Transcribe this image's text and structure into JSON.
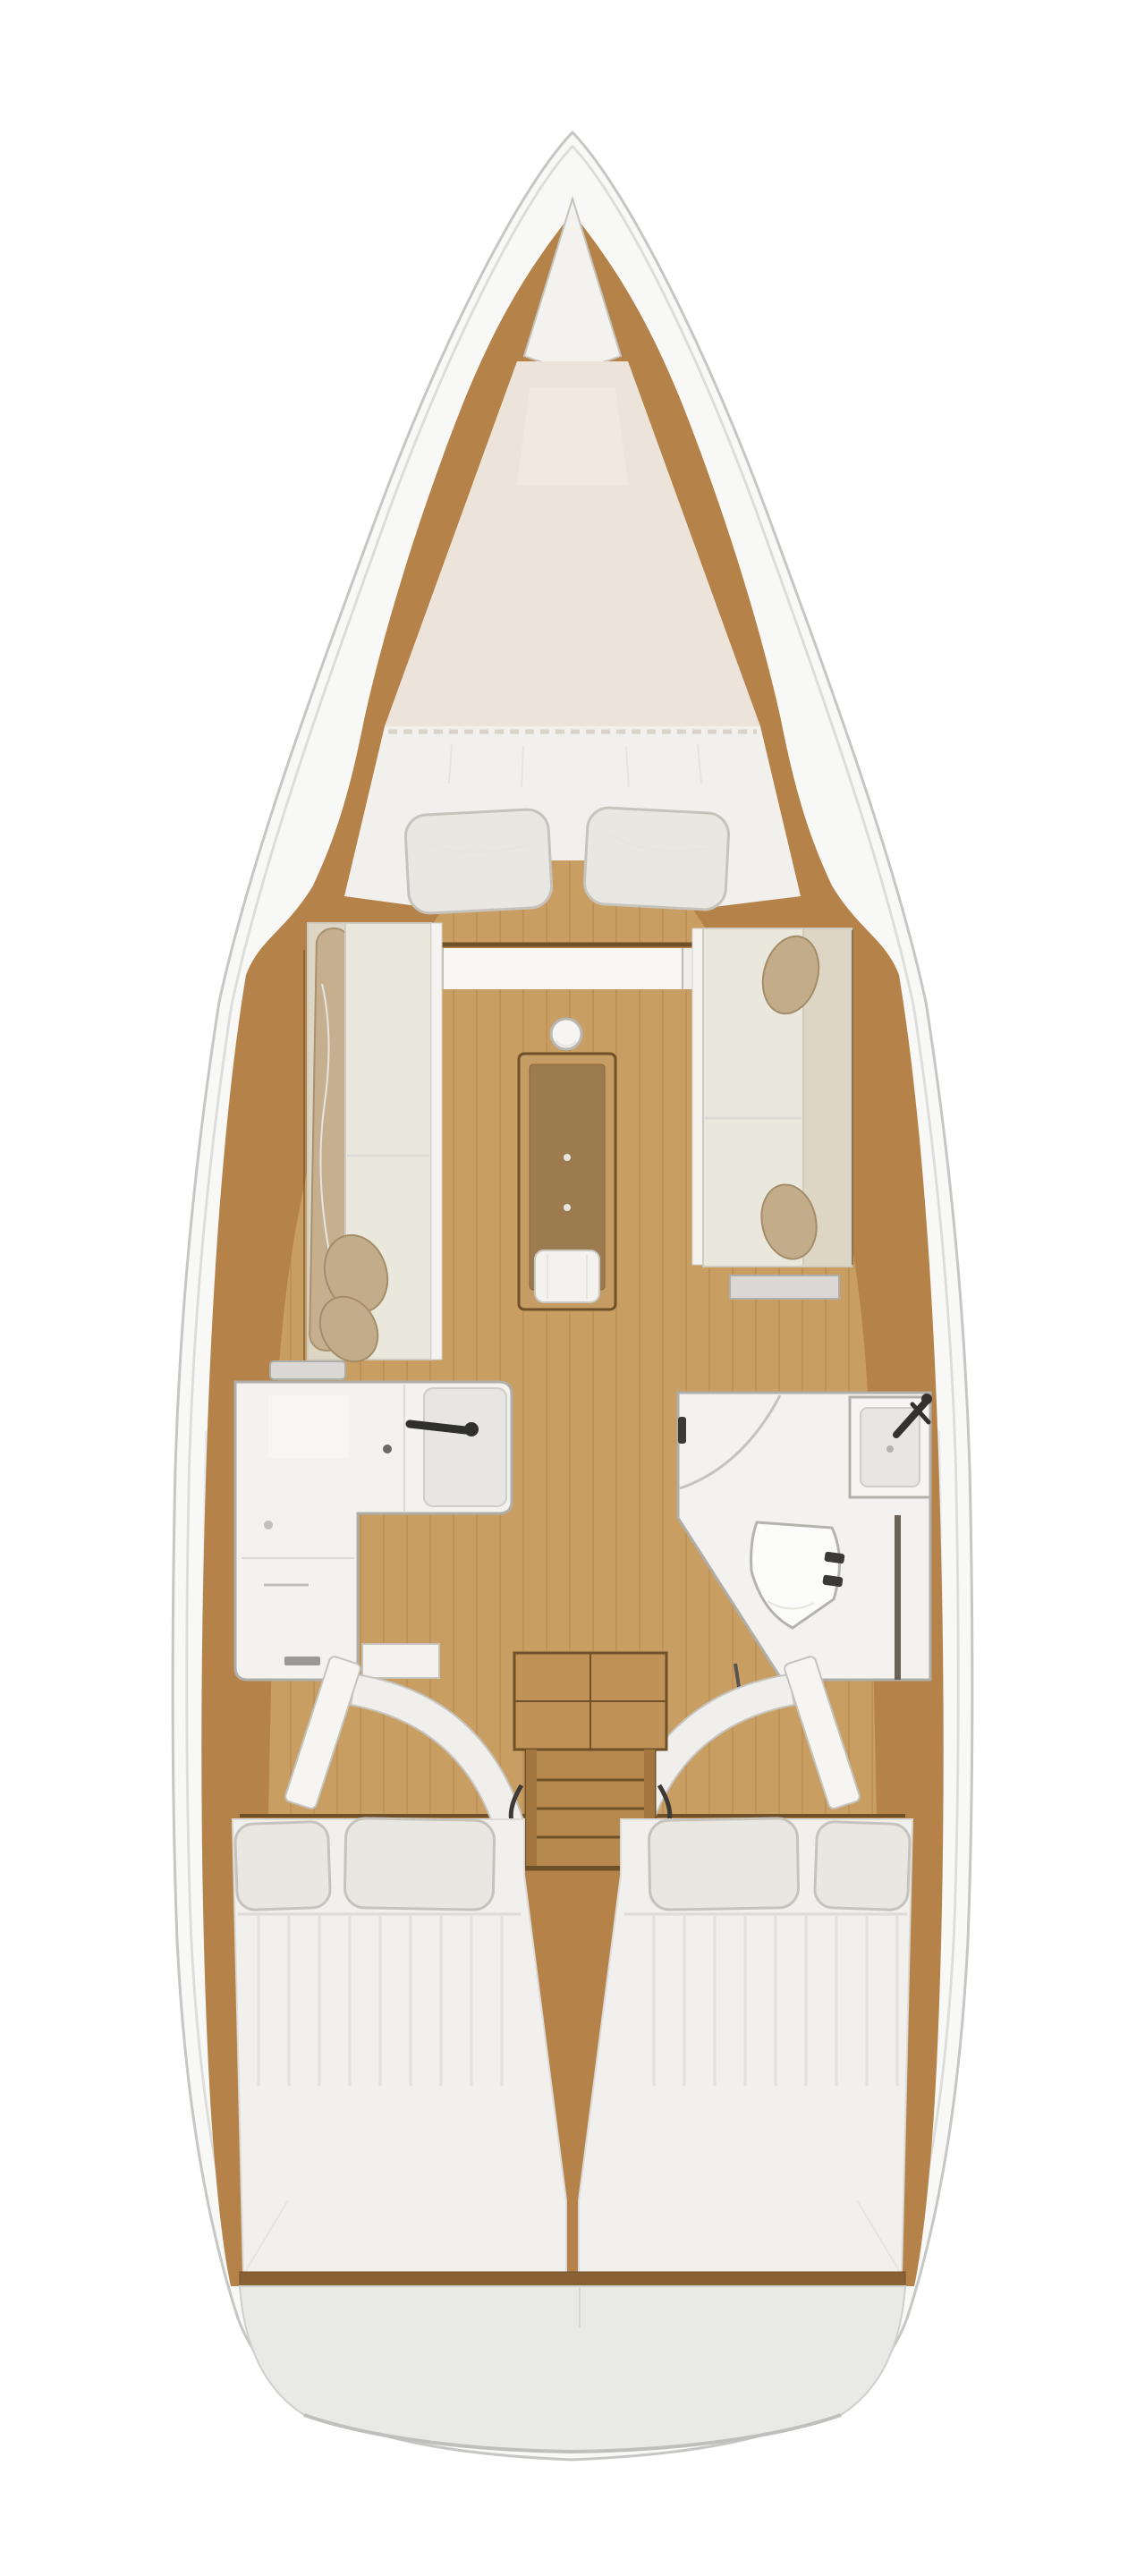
{
  "meta": {
    "title": "Sailboat interior layout plan (top-down)",
    "type": "yacht floor plan diagram",
    "text_labels": "none visible"
  },
  "areas": {
    "bow": {
      "name": "anchor locker",
      "shape": "triangular, at bow tip"
    },
    "forward_cabin": {
      "name": "forward V-berth cabin",
      "bed": "double V-berth, head aft",
      "pillow_count": 2
    },
    "salon": {
      "port_settee": "straight bench settee with rolled blanket backrest and 2 tan cushions",
      "starboard_settee": "settee with backrest and 2 tan cushions",
      "table": "rectangular drop-leaf saloon table with white base cylinder",
      "mast_post": "white round compression post forward of table"
    },
    "galley": {
      "name": "L-shaped galley, port side",
      "features": [
        "counter",
        "sink",
        "faucet",
        "burner knob",
        "drawers"
      ]
    },
    "head": {
      "name": "head compartment, starboard side",
      "features": [
        "shower area",
        "corner sink with faucet",
        "toilet",
        "angled door wall"
      ]
    },
    "companionway": {
      "name": "companionway stairs",
      "step_count": 4,
      "door_swing_arcs": 2,
      "open_door_leaves": 2
    },
    "aft_cabins": {
      "count": 2,
      "beds": "double berths side by side",
      "pillows_per_bed": 2
    },
    "stern": {
      "name": "transom / stern platform"
    }
  },
  "colors": {
    "hull_white": "#f8f8f7",
    "hull_stroke": "#c6c6c4",
    "hull_inner": "#dcdcda",
    "hull_shade": "#e4e7ea",
    "wood_band": "#b5834a",
    "wood_floor": "#c99e63",
    "plank_line": "#a97e45",
    "wood_dark": "#6e5128",
    "stair_wood": "#b8894e",
    "stair_light": "#c09257",
    "stair_stringer": "#a3763f",
    "table_frame": "#c59c63",
    "table_top": "#9c7b4e",
    "table_top_stroke": "#87653a",
    "white_furniture": "#f3f2ef",
    "furniture_stroke": "#b0aeaa",
    "cushion": "#eae7dd",
    "cushion_stroke": "#cfcbbe",
    "backrest": "#ded6c4",
    "tan_pillow": "#c3ac8a",
    "tan_stroke": "#a38c68",
    "bed_white": "#f1f0ed",
    "pillow_white": "#e9e7e2",
    "pillow_stroke": "#c6c3bc",
    "mattress": "#ece4da",
    "mattress_hatch": "#f0e9e0",
    "sheet_line": "#d9d3c9",
    "crease_line": "#e7e4de",
    "stern_gray": "#e9e9e8",
    "stern_stroke": "#cfcfcd",
    "fixture_dark": "#3c3a37",
    "metal_gray_light": "#d9d8d4",
    "shadow_line": "#dddbd7",
    "toilet_white": "#fbfbfa",
    "toilet_stroke": "#b5b3ae",
    "basin_gray": "#e7e6e3",
    "basin_stroke": "#cfcdc9"
  }
}
